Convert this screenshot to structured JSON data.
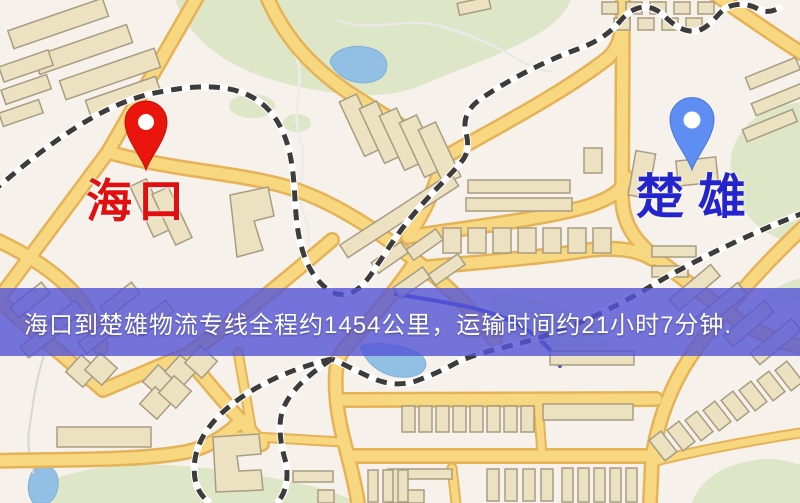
{
  "map": {
    "origin": {
      "name": "海口",
      "label_color": "#e01010",
      "pin_color": "#ea150d"
    },
    "destination": {
      "name": "楚雄",
      "label_color": "#2424cd",
      "pin_color": "#5e8ef2"
    },
    "banner": {
      "text": "海口到楚雄物流专线全程约1454公里，运输时间约21小时7分钟.",
      "bg_color": "#5454d6",
      "text_color": "#ffffff"
    },
    "route": {
      "from": "海口",
      "to": "楚雄",
      "distance_km": "1454",
      "duration": "21小时7分钟"
    }
  },
  "colors": {
    "map_background": "#f6f1ea",
    "park_green": "#dde6c6",
    "water_blue": "#92bfe4",
    "road_fill": "#f7d880",
    "road_casing": "#e6b258",
    "building_fill": "#ece1c0",
    "building_stroke": "#a89d82",
    "railway_dark": "#3c3c3c",
    "river_dark": "#3b4bc8"
  }
}
